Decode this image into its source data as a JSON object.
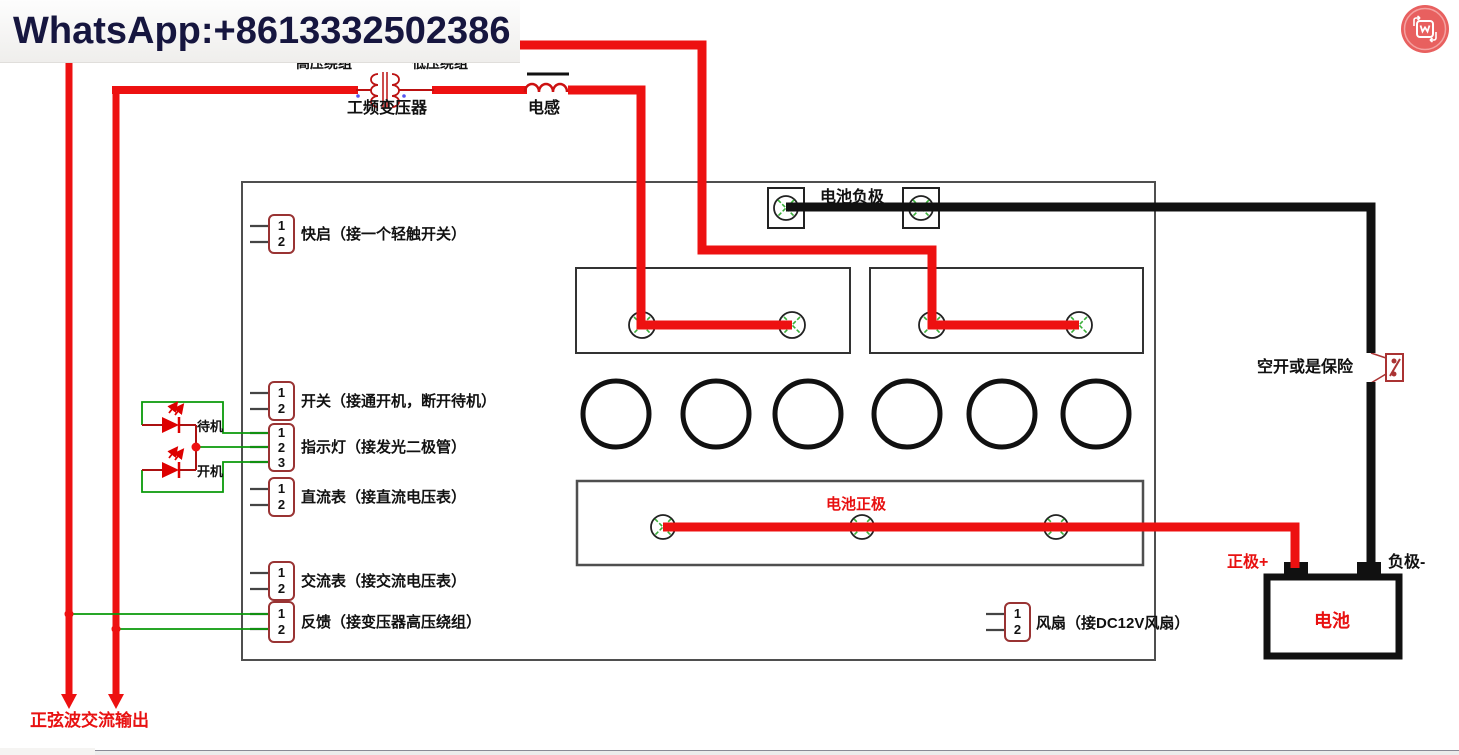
{
  "watermark": {
    "text": "WhatsApp:+8613332502386"
  },
  "header_icon": {
    "name": "watermark-app-logo-icon"
  },
  "transformer": {
    "name": "工频变压器",
    "hv_winding": "高压绕组",
    "lv_winding": "低压绕组"
  },
  "inductor": {
    "name": "电感"
  },
  "board": {
    "battery_negative": "电池负极",
    "battery_positive": "电池正极",
    "connectors": [
      {
        "id": "quick-start",
        "pins": [
          "1",
          "2"
        ],
        "label": "快启（接一个轻触开关）"
      },
      {
        "id": "power-switch",
        "pins": [
          "1",
          "2"
        ],
        "label": "开关（接通开机，断开待机）"
      },
      {
        "id": "indicator",
        "pins": [
          "1",
          "2",
          "3"
        ],
        "label": "指示灯（接发光二极管）"
      },
      {
        "id": "dc-meter",
        "pins": [
          "1",
          "2"
        ],
        "label": "直流表（接直流电压表）"
      },
      {
        "id": "ac-meter",
        "pins": [
          "1",
          "2"
        ],
        "label": "交流表（接交流电压表）"
      },
      {
        "id": "feedback",
        "pins": [
          "1",
          "2"
        ],
        "label": "反馈（接变压器高压绕组）"
      },
      {
        "id": "fan",
        "pins": [
          "1",
          "2"
        ],
        "label": "风扇（接DC12V风扇）"
      }
    ]
  },
  "leds": {
    "standby": "待机",
    "power_on": "开机"
  },
  "breaker": {
    "label": "空开或是保险"
  },
  "battery": {
    "name": "电池",
    "positive_terminal": "正极+",
    "negative_terminal": "负极-"
  },
  "ac_output": {
    "label": "正弦波交流输出"
  },
  "colors": {
    "wire_red": "#ed1111",
    "wire_black": "#111111",
    "wire_green": "#0a9a0a",
    "connector_border": "#993333",
    "led_red": "#dd0000",
    "icon_bg": "#e8605f"
  }
}
